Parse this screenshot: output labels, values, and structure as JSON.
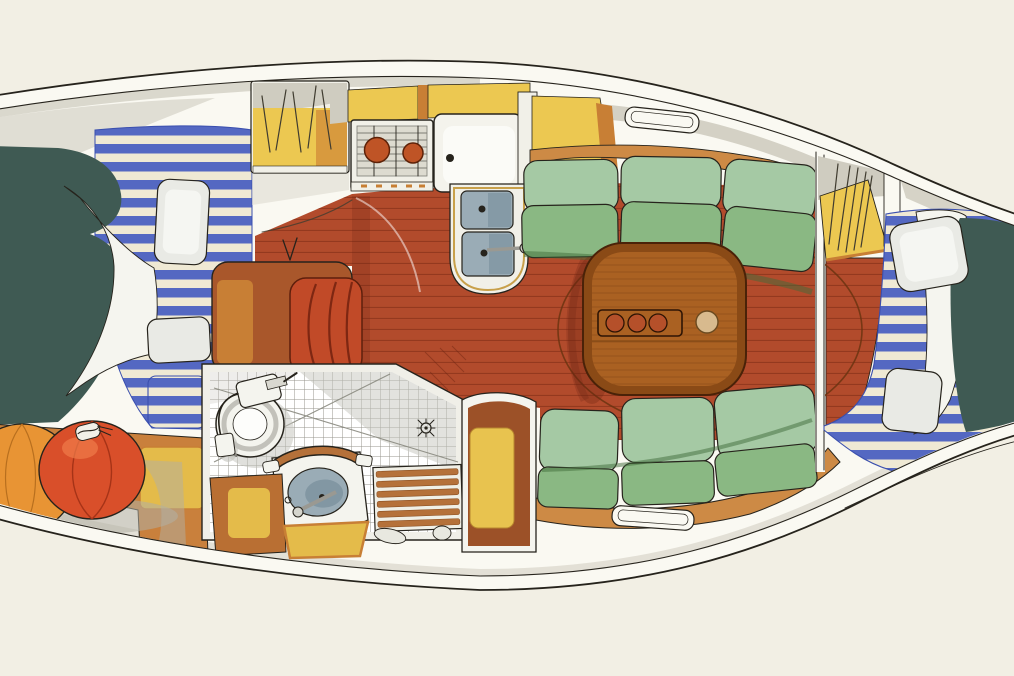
{
  "description": "Hand-drawn watercolor plan view of a sailboat interior: V-berth with navy blanket, white sheet and blue striped cushions at the bow, two stowed orange fenders, galley with two-burner stove, countertop and double sink, saloon with green settees and an oval wooden table holding a three-bottle tray and a bowl on a red-brown planked sole, a tiled head with toilet, wash basin, grab rail and teak shower grating, pencil-hatched hanging lockers, and an aft double berth with blue striped mattress, white pillows and navy blanket.",
  "regions": [
    "hull",
    "foredeck",
    "v-berth",
    "fenders",
    "galley-stove",
    "galley-counter",
    "galley-sink",
    "saloon-floor",
    "saloon-table",
    "top-settee",
    "bottom-settee",
    "head-compartment",
    "toilet",
    "head-basin",
    "teak-grating",
    "wardrobe",
    "nav-locker",
    "aft-berth"
  ],
  "colors": {
    "paper": "#f2efe4",
    "ink": "#26231c",
    "pencil": "#403c30",
    "hull_white": "#faf9f2",
    "deck_gray": "#cfccc0",
    "deck_gray_soft": "#dedbd0",
    "teal": "#3f5a53",
    "sheet_white": "#f5f5ef",
    "stripe_blue": "#5468c2",
    "stripe_blue_deep": "#3a4fae",
    "stripe_cream": "#efe9d4",
    "pillow": "#e9eae5",
    "pillow_hi": "#f5f6f2",
    "pillow_shade": "#c9cac4",
    "shelf_wood": "#c9803c",
    "fender_orange": "#e89434",
    "fender_orange_deep": "#b86f1e",
    "fender_red": "#d94f2a",
    "fender_red_deep": "#a63317",
    "fender_hi": "#ef7c4a",
    "locker_yellow": "#ecc851",
    "locker_orange": "#d89a3e",
    "trim_orange": "#c87f35",
    "stove_white": "#f1f0e8",
    "stove_inner": "#dddbd0",
    "grate_line": "#7d7c74",
    "burner": "#bf5426",
    "counter_white": "#f4f3ec",
    "counter_hi": "#fbfbf7",
    "pod_trim": "#c8a04a",
    "basin": "#9aacb6",
    "basin_deep": "#748c99",
    "metal": "#9a9992",
    "metal_hi": "#d5d5cd",
    "floor_red": "#b24b2c",
    "floor_plank": "#7c2a14",
    "floor_shadow": "#6b2312",
    "seat_block_brown": "#a9572b",
    "seat_cushion_red": "#c14a28",
    "seat_cushion_line": "#7e2712",
    "settee_light": "#a5c9a4",
    "settee_mid": "#8ab883",
    "settee_dark": "#74a46c",
    "settee_gap": "#3f6b3a",
    "settee_shelf": "#cd8a45",
    "table_wood": "#aa6122",
    "table_rim": "#6b3410",
    "table_edge": "#8a4a16",
    "table_grain": "#7c4514",
    "tray_red": "#b5502a",
    "tray_ink": "#2e1404",
    "bowl_tan": "#d8ba8e",
    "bowl_rim": "#6b4a20",
    "tile_bg": "#f0efe8",
    "tile_line": "#97968e",
    "tile_shade": "#c6c5bd",
    "fixture_white": "#f4f4ee",
    "fixture_gray": "#c2c1ba",
    "teak": "#b5713a",
    "teak_dark": "#8a4f22",
    "wardrobe_brown": "#9c5128",
    "wardrobe_yellow": "#e8c34f",
    "head_cab_brown": "#b96f33",
    "head_cab_yellow": "#e4bb4a",
    "shadow_gray": "#b1afa4"
  }
}
